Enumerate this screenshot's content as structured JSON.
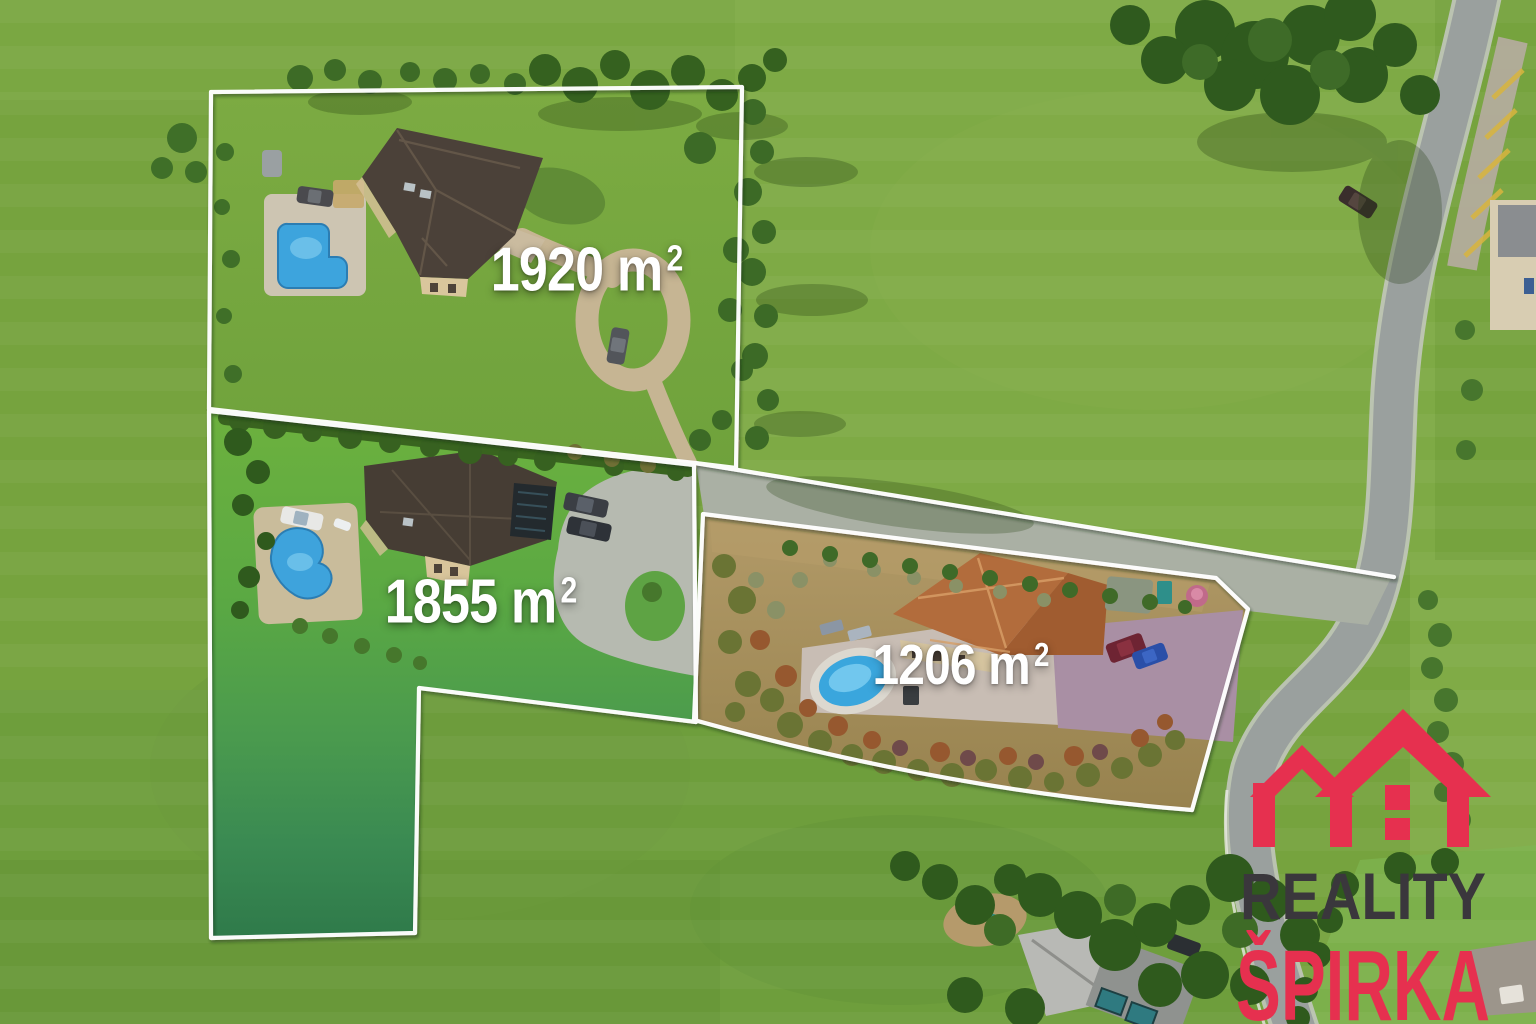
{
  "plots": [
    {
      "id": "plot-1",
      "label": "1920 m",
      "sup": "2",
      "area": "1920 m²"
    },
    {
      "id": "plot-2",
      "label": "1855 m",
      "sup": "2",
      "area": "1855 m²"
    },
    {
      "id": "plot-3",
      "label": "1206 m",
      "sup": "2",
      "area": "1206 m²"
    }
  ],
  "logo": {
    "line1": "REALITY",
    "line2": "ŠPIRKA"
  },
  "colors": {
    "outline": "#ffffff",
    "label_text": "#ffffff",
    "logo_accent": "#e6304f",
    "logo_dark": "#3a373c"
  }
}
